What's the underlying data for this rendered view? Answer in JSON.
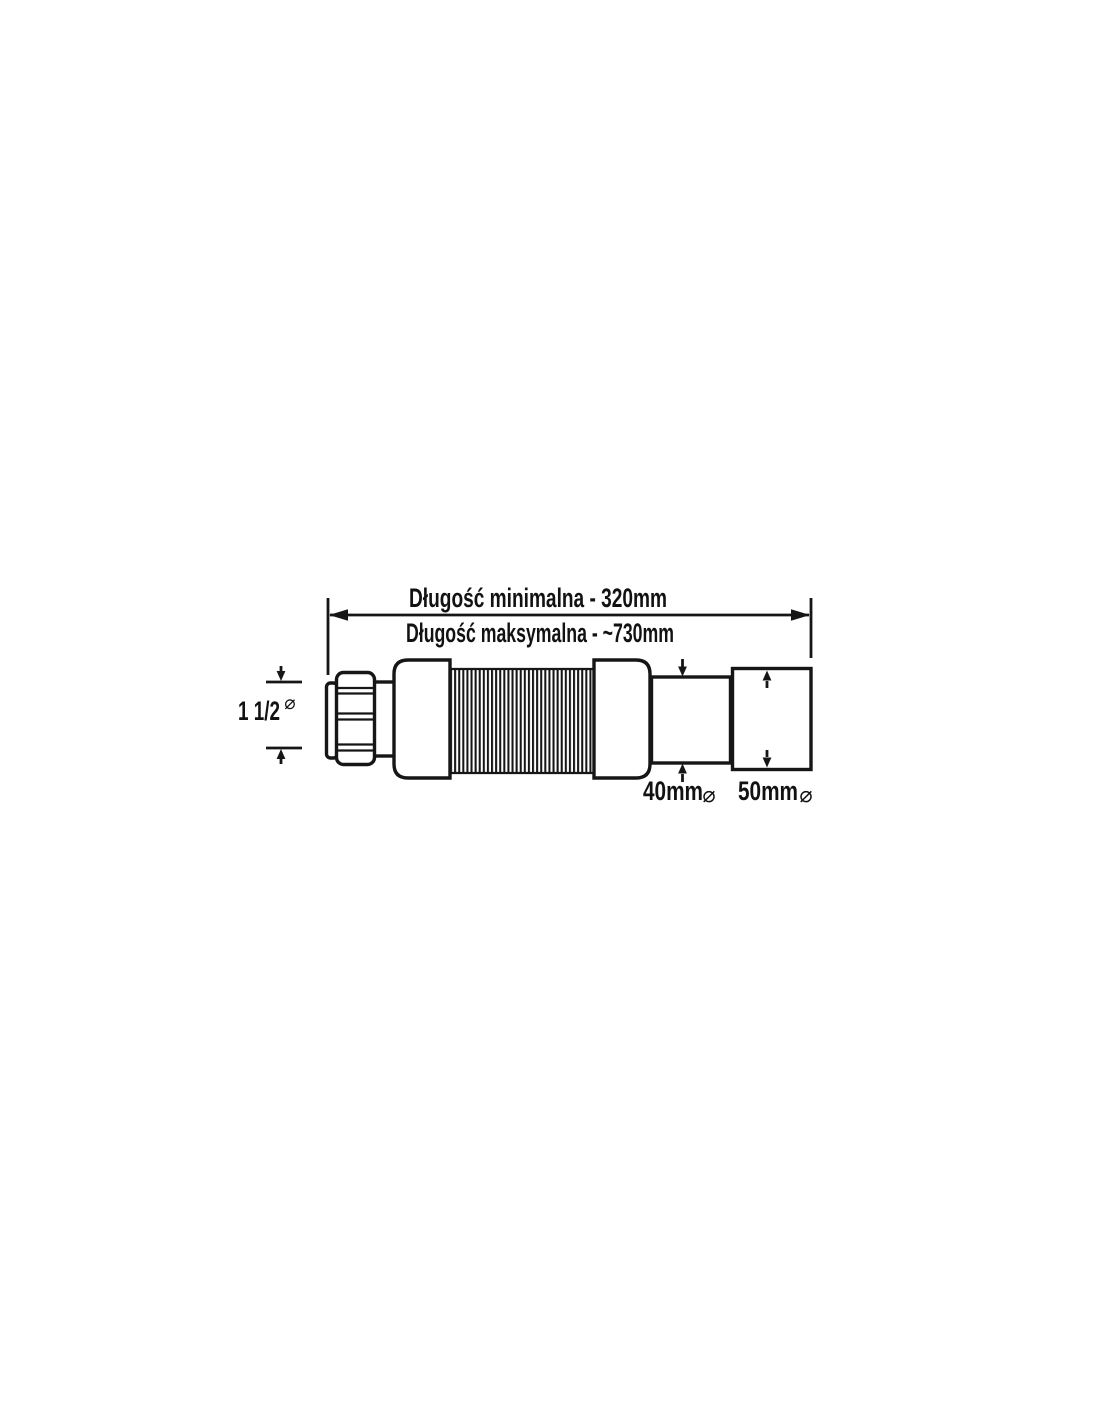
{
  "page": {
    "background_color": "#ffffff",
    "ink_color": "#161616"
  },
  "diagram": {
    "type": "technical-drawing",
    "subject": "flexible waste pipe connector",
    "labels": {
      "length_min": "Długość minimalna - 320mm",
      "length_max": "Długość maksymalna - ~730mm",
      "inlet_size": "1 1/2",
      "inlet_phi": "⌀",
      "outlet_small": "40mm",
      "outlet_small_phi": "⌀",
      "outlet_large": "50mm",
      "outlet_large_phi": "⌀"
    },
    "dimensions_mm": {
      "minimum_length": 320,
      "maximum_length_approx": 730,
      "inlet_diameter_inches": "1 1/2",
      "outlet_small_diameter": 40,
      "outlet_large_diameter": 50
    }
  }
}
